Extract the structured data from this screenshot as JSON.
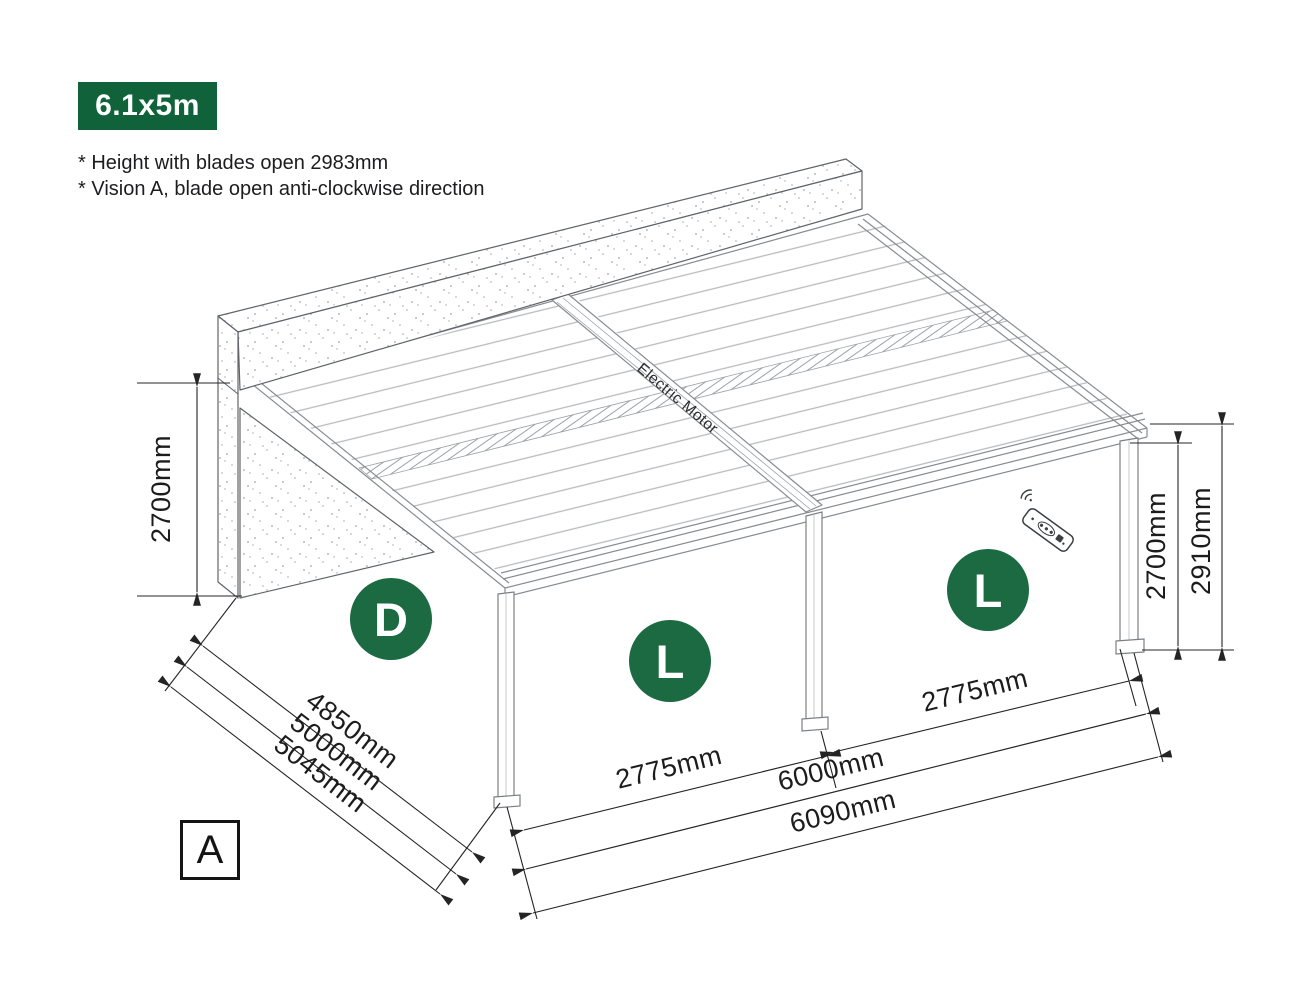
{
  "badge": {
    "label": "6.1x5m"
  },
  "notes": {
    "line1": "* Height with blades open 2983mm",
    "line2": "* Vision A, blade open anti-clockwise direction"
  },
  "view_marker": {
    "label": "A"
  },
  "diagram": {
    "motor_label": "Electric Motor",
    "zone_markers": {
      "left": "D",
      "middle": "L",
      "right": "L"
    },
    "dimensions": {
      "wall_height": "2700mm",
      "depth_blades": "4850mm",
      "depth_posts": "5000mm",
      "depth_overall": "5045mm",
      "bay_left_width": "2775mm",
      "bay_right_width": "2775mm",
      "width_posts": "6000mm",
      "width_overall": "6090mm",
      "post_height": "2700mm",
      "overall_height": "2910mm"
    }
  },
  "colors": {
    "badge_green": "#0f6239",
    "marker_green": "#1b6a41"
  }
}
